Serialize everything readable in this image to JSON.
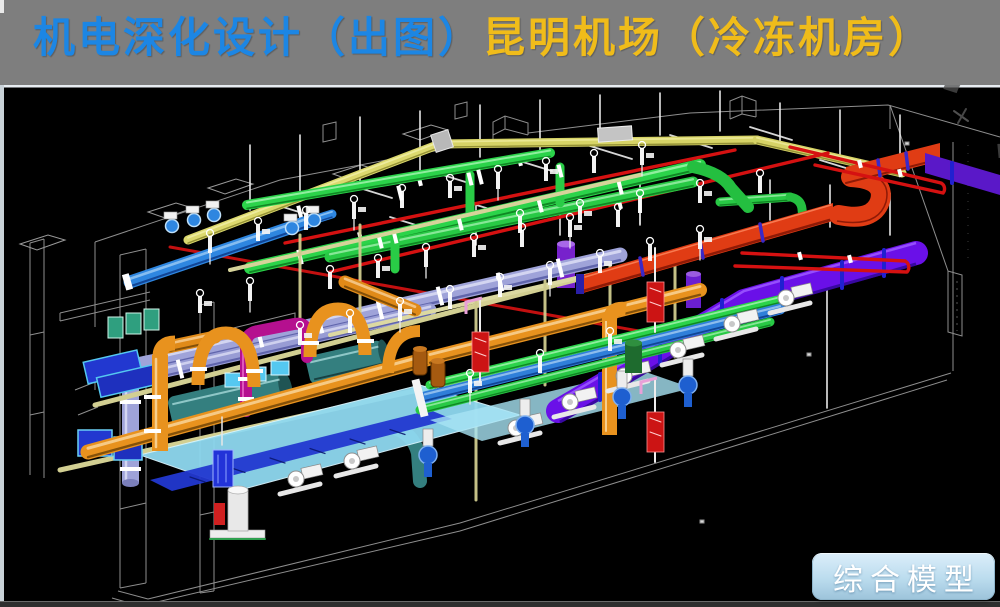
{
  "header": {
    "title_primary": "机电深化设计（出图）",
    "title_secondary": "昆明机场（冷冻机房）"
  },
  "badge": {
    "label": "综合模型"
  },
  "colors": {
    "header_background": "#7E7E7E",
    "title_primary": "#1C86E4",
    "title_secondary": "#F0BC1A",
    "viewport_background": "#000000",
    "badge_top": "#DCEEFA",
    "badge_bottom": "#9CC3DA",
    "badge_text": "#FFFFFF",
    "pipe_green": "#2BD34A",
    "pipe_blue": "#2E86E0",
    "pipe_lavender": "#9FA3D9",
    "pipe_orange": "#E8921E",
    "pipe_red": "#D51111",
    "pipe_magenta": "#B5108F",
    "duct_yellow": "#DCD96E",
    "duct_orange_red": "#E03C14",
    "duct_violet": "#6A10E8",
    "tank_teal": "#347F7F",
    "platform_cyan": "#8FD9F0",
    "box_royal_blue": "#2238D0",
    "wireframe_gray": "#8E8E8E"
  }
}
